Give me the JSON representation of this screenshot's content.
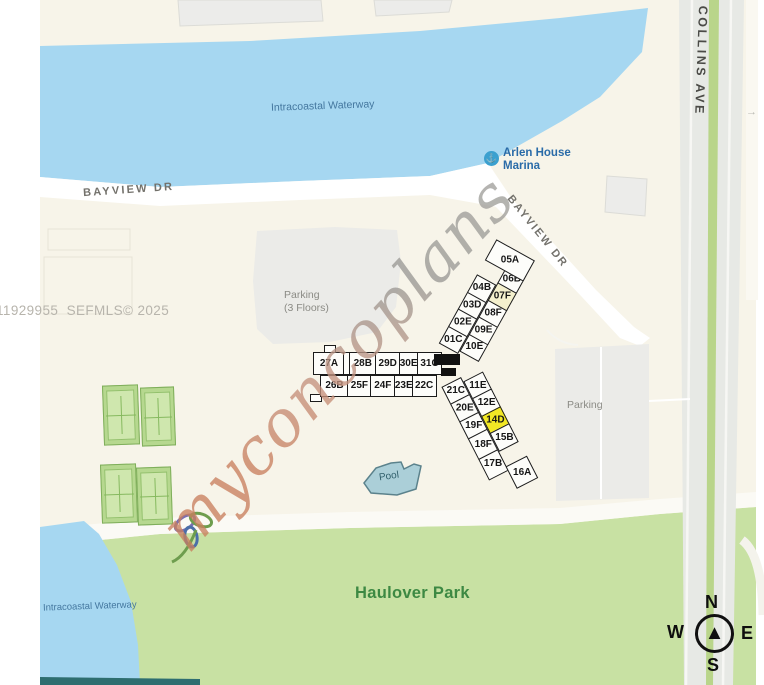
{
  "map": {
    "mls_credit": "11929955  SEFMLS© 2025",
    "watermark": "myconcoplans",
    "labels": {
      "waterway_top": "Intracoastal Waterway",
      "waterway_bottom": "Intracoastal Waterway",
      "bayview_top": "BAYVIEW DR",
      "bayview_diag": "BAYVIEW DR",
      "collins": "COLLINS AVE",
      "marina": "Arlen House\nMarina",
      "parking_garage": "Parking\n(3 Floors)",
      "parking_lot": "Parking",
      "pool": "Pool",
      "park": "Haulover Park"
    },
    "icons": {
      "anchor": "⚓",
      "compass_arrow": "▲",
      "arrow_right": "→"
    },
    "compass": {
      "n": "N",
      "e": "E",
      "s": "S",
      "w": "W"
    }
  },
  "building": {
    "highlighted_unit": "14D",
    "tinted_unit": "07F",
    "wings": {
      "west": {
        "top_row": [
          "27A",
          "",
          "28B",
          "29D",
          "30E",
          "31C"
        ],
        "bottom_row": [
          "26B",
          "25F",
          "24F",
          "23E",
          "22C"
        ]
      },
      "north": {
        "row_outer": [
          "01C",
          "02E",
          "03D",
          "04B"
        ],
        "row_inner": [
          "10E",
          "09E",
          "08F",
          "07F",
          "06B"
        ],
        "tip": "05A"
      },
      "south": {
        "row_inner": [
          "11E",
          "12E",
          "14D",
          "15B"
        ],
        "row_outer": [
          "21C",
          "20E",
          "19F",
          "18F",
          "17B"
        ],
        "tip": "16A"
      }
    }
  },
  "colors": {
    "land": "#f7f4e9",
    "water": "#a6d7f1",
    "park": "#c8e1a3",
    "road_gray": "#e7e9e5",
    "median_green": "#b9d58a",
    "building_gray": "#ececea",
    "parking_gray": "#ebebe8",
    "unit_bg": "#fdfdfa",
    "unit_highlight": "#f2e825",
    "unit_tint": "#f4f0cd",
    "pool_fill": "#abcfd8",
    "pool_stroke": "#5b828c",
    "court_green": "#b6d88f",
    "court_light": "#cfe7ae",
    "shore_dark": "#2e6e70",
    "text_blue": "#44779f",
    "text_green": "#3d8943",
    "text_gray": "#b7b4ac",
    "text_road": "#73716b",
    "text_dark": "#4b4b47"
  }
}
